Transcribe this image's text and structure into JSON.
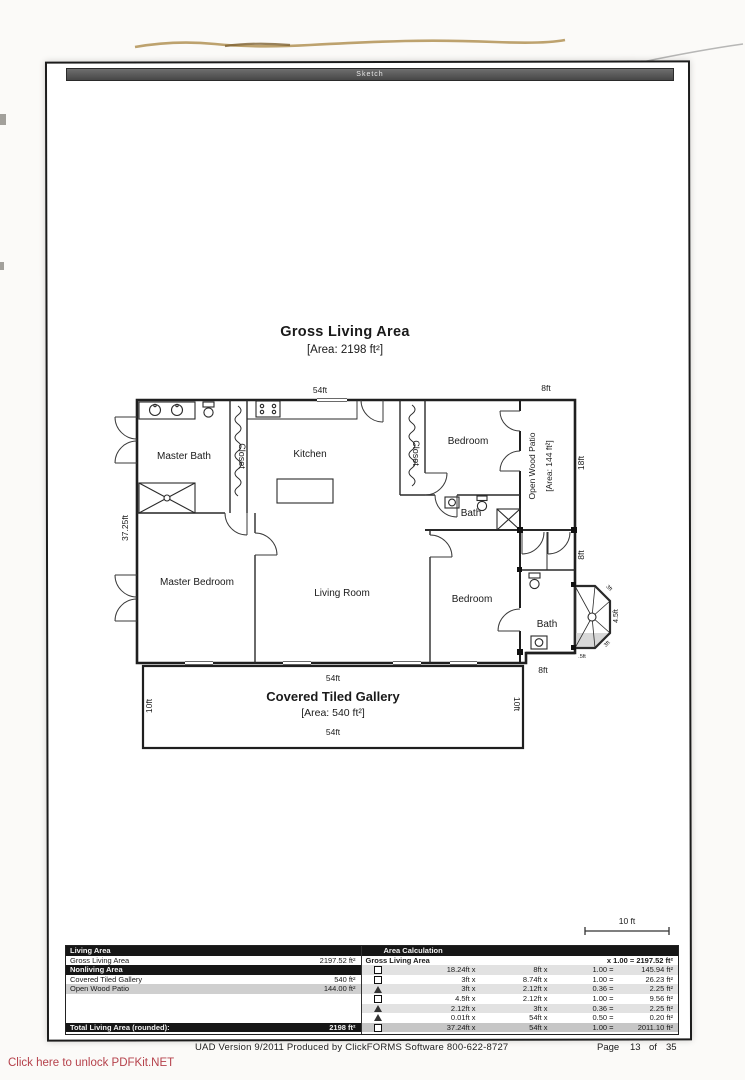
{
  "page": {
    "sketch_bar": "Sketch",
    "unlock_link": "Click here to unlock PDFKit.NET"
  },
  "plan": {
    "title": "Gross Living Area",
    "area": "[Area: 2198 ft²]",
    "scale_label": "10 ft",
    "rooms": {
      "master_bath": "Master Bath",
      "closet1": "Closet",
      "kitchen": "Kitchen",
      "closet2": "Closet",
      "bedroom_top": "Bedroom",
      "bath_mid": "Bath",
      "master_bedroom": "Master Bedroom",
      "living_room": "Living Room",
      "bedroom_bottom": "Bedroom",
      "bath_bottom": "Bath"
    },
    "patio": {
      "label": "Open Wood Patio",
      "area": "[Area: 144 ft²]"
    },
    "gallery": {
      "title": "Covered Tiled Gallery",
      "area": "[Area: 540 ft²]",
      "top_dim": "54ft",
      "bottom_dim": "54ft",
      "left_dim": "10ft",
      "right_dim": "10ft"
    },
    "dims": {
      "top": "54ft",
      "patio_top": "8ft",
      "left": "37.25ft",
      "patio_right": "18ft",
      "right_mid": "8ft",
      "shower_right": "4.5ft",
      "shower_top": "3ft",
      "shower_bottom": "3ft",
      "shower_small": ".5ft",
      "bath_bottom": "8ft"
    }
  },
  "table": {
    "left": {
      "header1": "Living Area",
      "gla_label": "Gross Living Area",
      "gla_value": "2197.52 ft²",
      "header2": "Nonliving Area",
      "row1_label": "Covered Tiled Gallery",
      "row1_value": "540 ft²",
      "row2_label": "Open Wood Patio",
      "row2_value": "144.00 ft²",
      "total_label": "Total Living Area (rounded):",
      "total_value": "2198 ft²"
    },
    "right": {
      "header": "Area Calculation",
      "gla_label": "Gross Living Area",
      "gla_formula": "x 1.00 = 2197.52 ft²",
      "rows": [
        {
          "shape": "square",
          "dim1": "18.24ft x",
          "dim2": "8ft x",
          "factor": "1.00 =",
          "result": "145.94 ft²"
        },
        {
          "shape": "square",
          "dim1": "3ft x",
          "dim2": "8.74ft x",
          "factor": "1.00 =",
          "result": "26.23 ft²"
        },
        {
          "shape": "triangle",
          "dim1": "3ft x",
          "dim2": "2.12ft x",
          "factor": "0.36 =",
          "result": "2.25 ft²"
        },
        {
          "shape": "square",
          "dim1": "4.5ft x",
          "dim2": "2.12ft x",
          "factor": "1.00 =",
          "result": "9.56 ft²"
        },
        {
          "shape": "triangle",
          "dim1": "2.12ft x",
          "dim2": "3ft x",
          "factor": "0.36 =",
          "result": "2.25 ft²"
        },
        {
          "shape": "triangle",
          "dim1": "0.01ft x",
          "dim2": "54ft x",
          "factor": "0.50 =",
          "result": "0.20 ft²"
        },
        {
          "shape": "square",
          "dim1": "37.24ft x",
          "dim2": "54ft x",
          "factor": "1.00 =",
          "result": "2011.10 ft²"
        }
      ]
    }
  },
  "footer": {
    "text": "UAD Version 9/2011 Produced by ClickFORMS Software 800-622-8727",
    "page_label": "Page",
    "page_num": "13",
    "of_label": "of",
    "page_total": "35"
  }
}
